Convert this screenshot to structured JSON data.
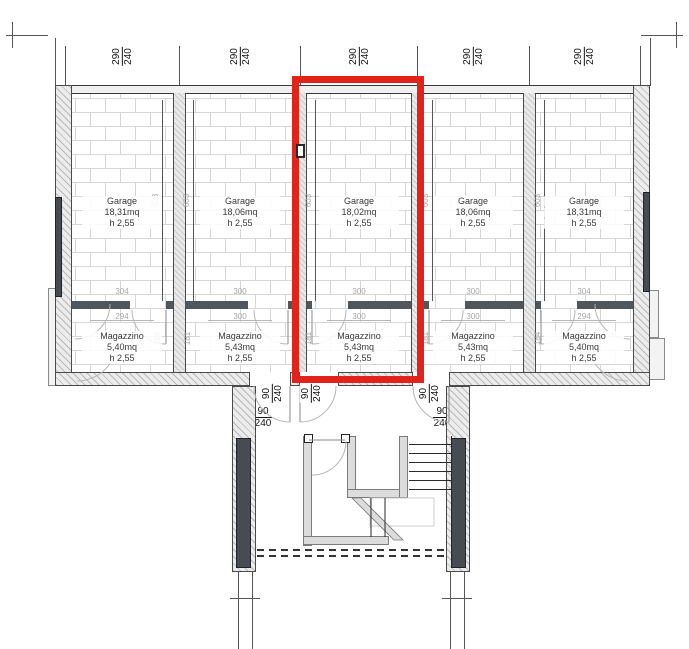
{
  "labels": {
    "garage": "Garage",
    "magazzino": "Magazzino",
    "height": "h 2,55"
  },
  "units": [
    {
      "garage_area": "18,31mq",
      "magazzino_area": "5,40mq",
      "width_dim": {
        "num": "290",
        "den": "240"
      },
      "garage_depth": "603",
      "opening_width": "304",
      "opening_inner": "294",
      "magazzino_depth": "184"
    },
    {
      "garage_area": "18,06mq",
      "magazzino_area": "5,43mq",
      "width_dim": {
        "num": "290",
        "den": "240"
      },
      "garage_depth": "603",
      "opening_width": "300",
      "opening_inner": "300",
      "magazzino_depth": "181"
    },
    {
      "garage_area": "18,02mq",
      "magazzino_area": "5,43mq",
      "width_dim": {
        "num": "290",
        "den": "240"
      },
      "garage_depth": "603",
      "opening_width": "300",
      "opening_inner": "300",
      "magazzino_depth": "181",
      "highlighted": true
    },
    {
      "garage_area": "18,06mq",
      "magazzino_area": "5,43mq",
      "width_dim": {
        "num": "290",
        "den": "240"
      },
      "garage_depth": "603",
      "opening_width": "300",
      "opening_inner": "300",
      "magazzino_depth": "181"
    },
    {
      "garage_area": "18,31mq",
      "magazzino_area": "5,40mq",
      "width_dim": {
        "num": "290",
        "den": "240"
      },
      "garage_depth": "603",
      "opening_width": "304",
      "opening_inner": "294",
      "magazzino_depth": "184"
    }
  ],
  "door_dims": {
    "rotated": [
      {
        "num": "90",
        "den": "240"
      },
      {
        "num": "90",
        "den": "240"
      },
      {
        "num": "90",
        "den": "240"
      }
    ],
    "horizontal": [
      {
        "num": "90",
        "den": "240"
      },
      {
        "num": "90",
        "den": "240"
      }
    ]
  },
  "highlight": {
    "color": "#e2231a",
    "unit_index": 3
  }
}
